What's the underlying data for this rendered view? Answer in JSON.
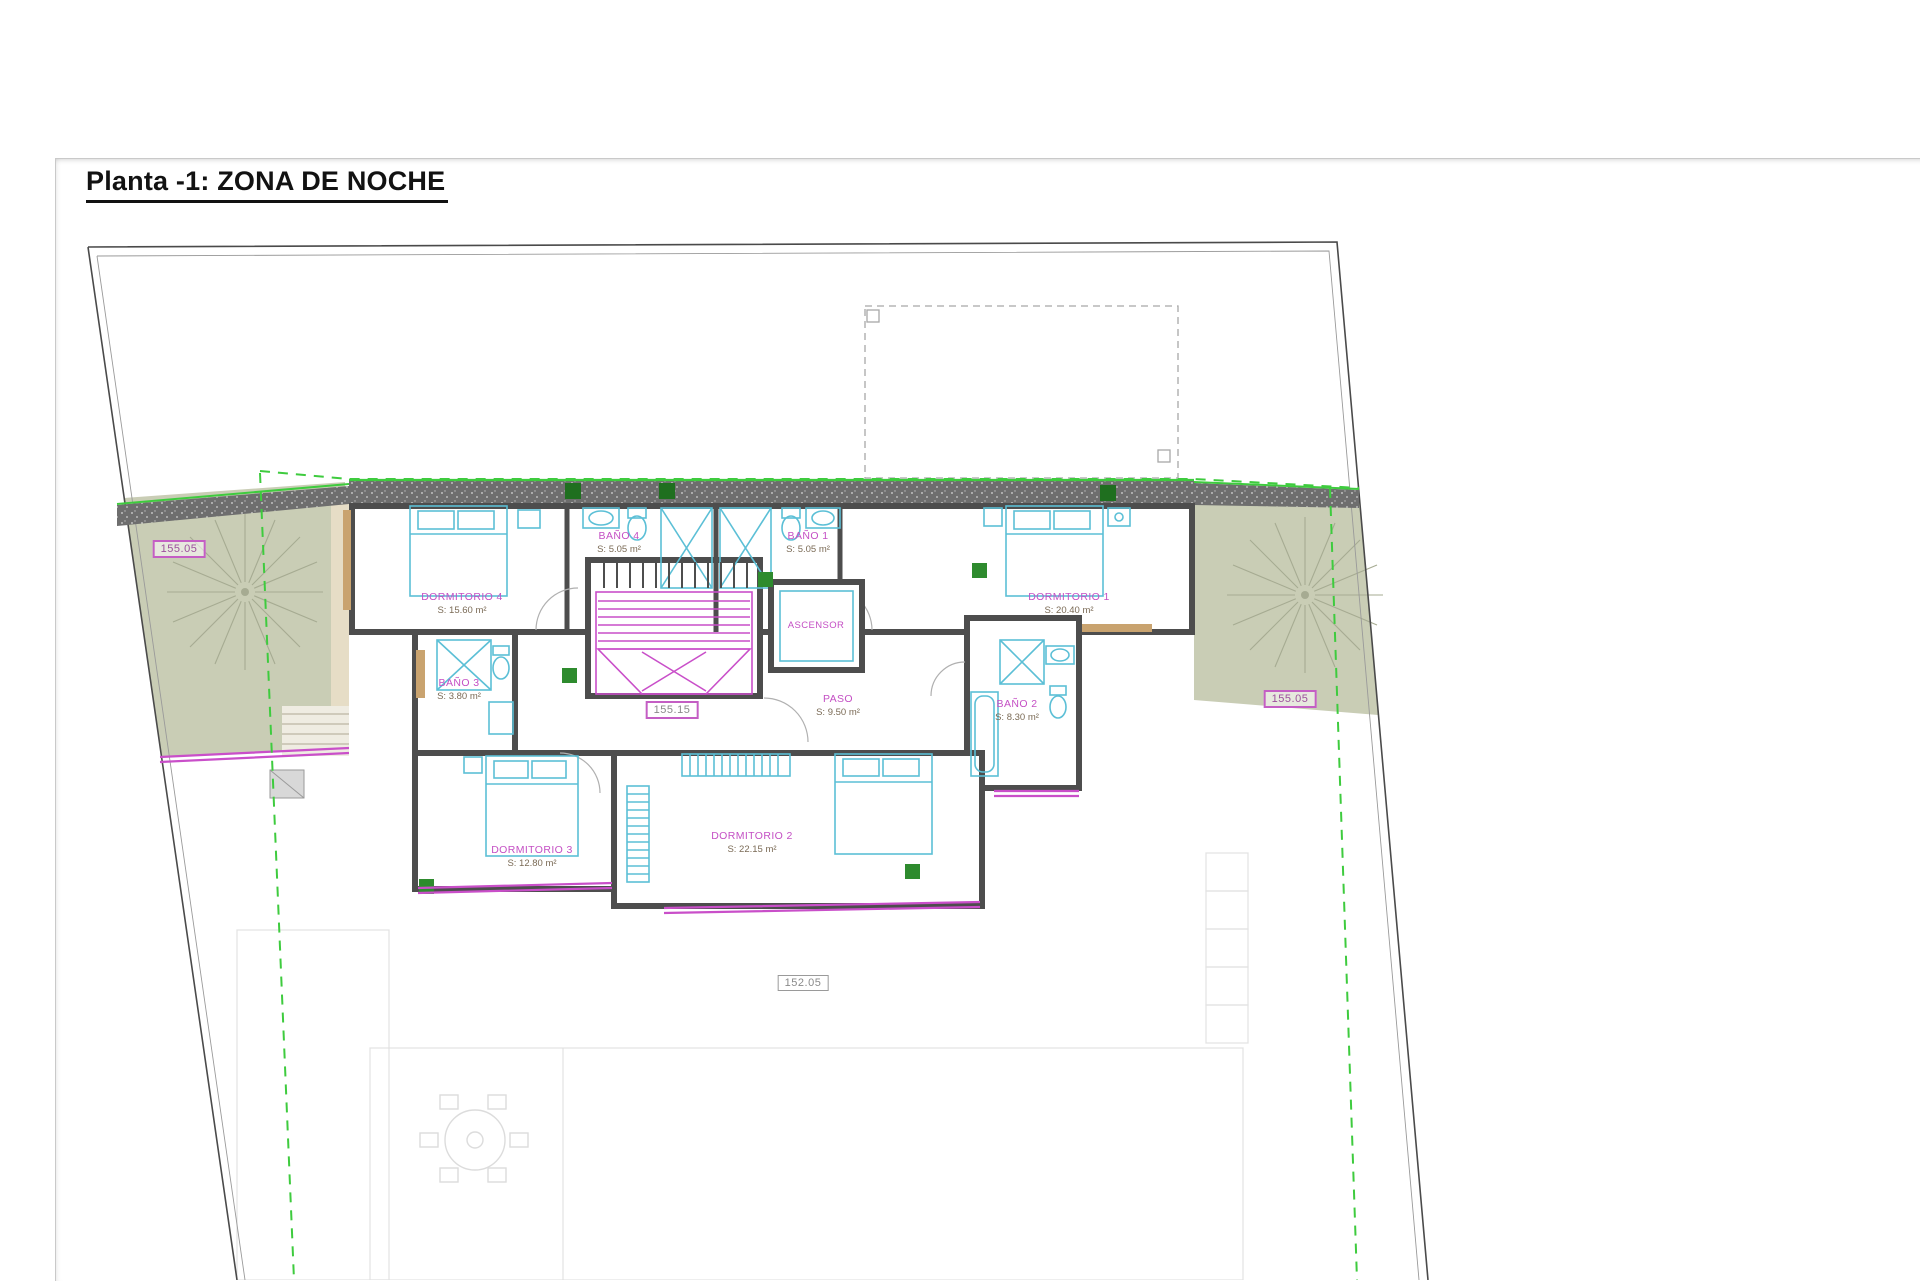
{
  "title": "Planta -1: ZONA DE NOCHE",
  "rooms": [
    {
      "name": "DORMITORIO 4",
      "area": "S: 15.60 m²"
    },
    {
      "name": "BAÑO 4",
      "area": "S: 5.05 m²"
    },
    {
      "name": "BAÑO 1",
      "area": "S: 5.05 m²"
    },
    {
      "name": "DORMITORIO 1",
      "area": "S: 20.40 m²"
    },
    {
      "name": "BAÑO 3",
      "area": "S: 3.80 m²"
    },
    {
      "name": "ASCENSOR",
      "area": ""
    },
    {
      "name": "PASO",
      "area": "S: 9.50 m²"
    },
    {
      "name": "BAÑO 2",
      "area": "S: 8.30 m²"
    },
    {
      "name": "DORMITORIO 3",
      "area": "S: 12.80 m²"
    },
    {
      "name": "DORMITORIO 2",
      "area": "S: 22.15 m²"
    }
  ],
  "elevations": [
    {
      "value": "155.05"
    },
    {
      "value": "155.15"
    },
    {
      "value": "155.05"
    },
    {
      "value": "152.05"
    }
  ],
  "symbols": {
    "tree": "tree-icon",
    "stairs": "stairs-icon",
    "elevator": "elevator-icon",
    "shower": "shower-x-icon",
    "wardrobe": "wardrobe-x-icon"
  },
  "colors": {
    "label_magenta": "#c44fc4",
    "fixture_cyan": "#5bbfd6",
    "setback_green": "#3ecb3e",
    "terrace_olive": "#c9cdb5",
    "wall_gray": "#4d4d4d"
  }
}
